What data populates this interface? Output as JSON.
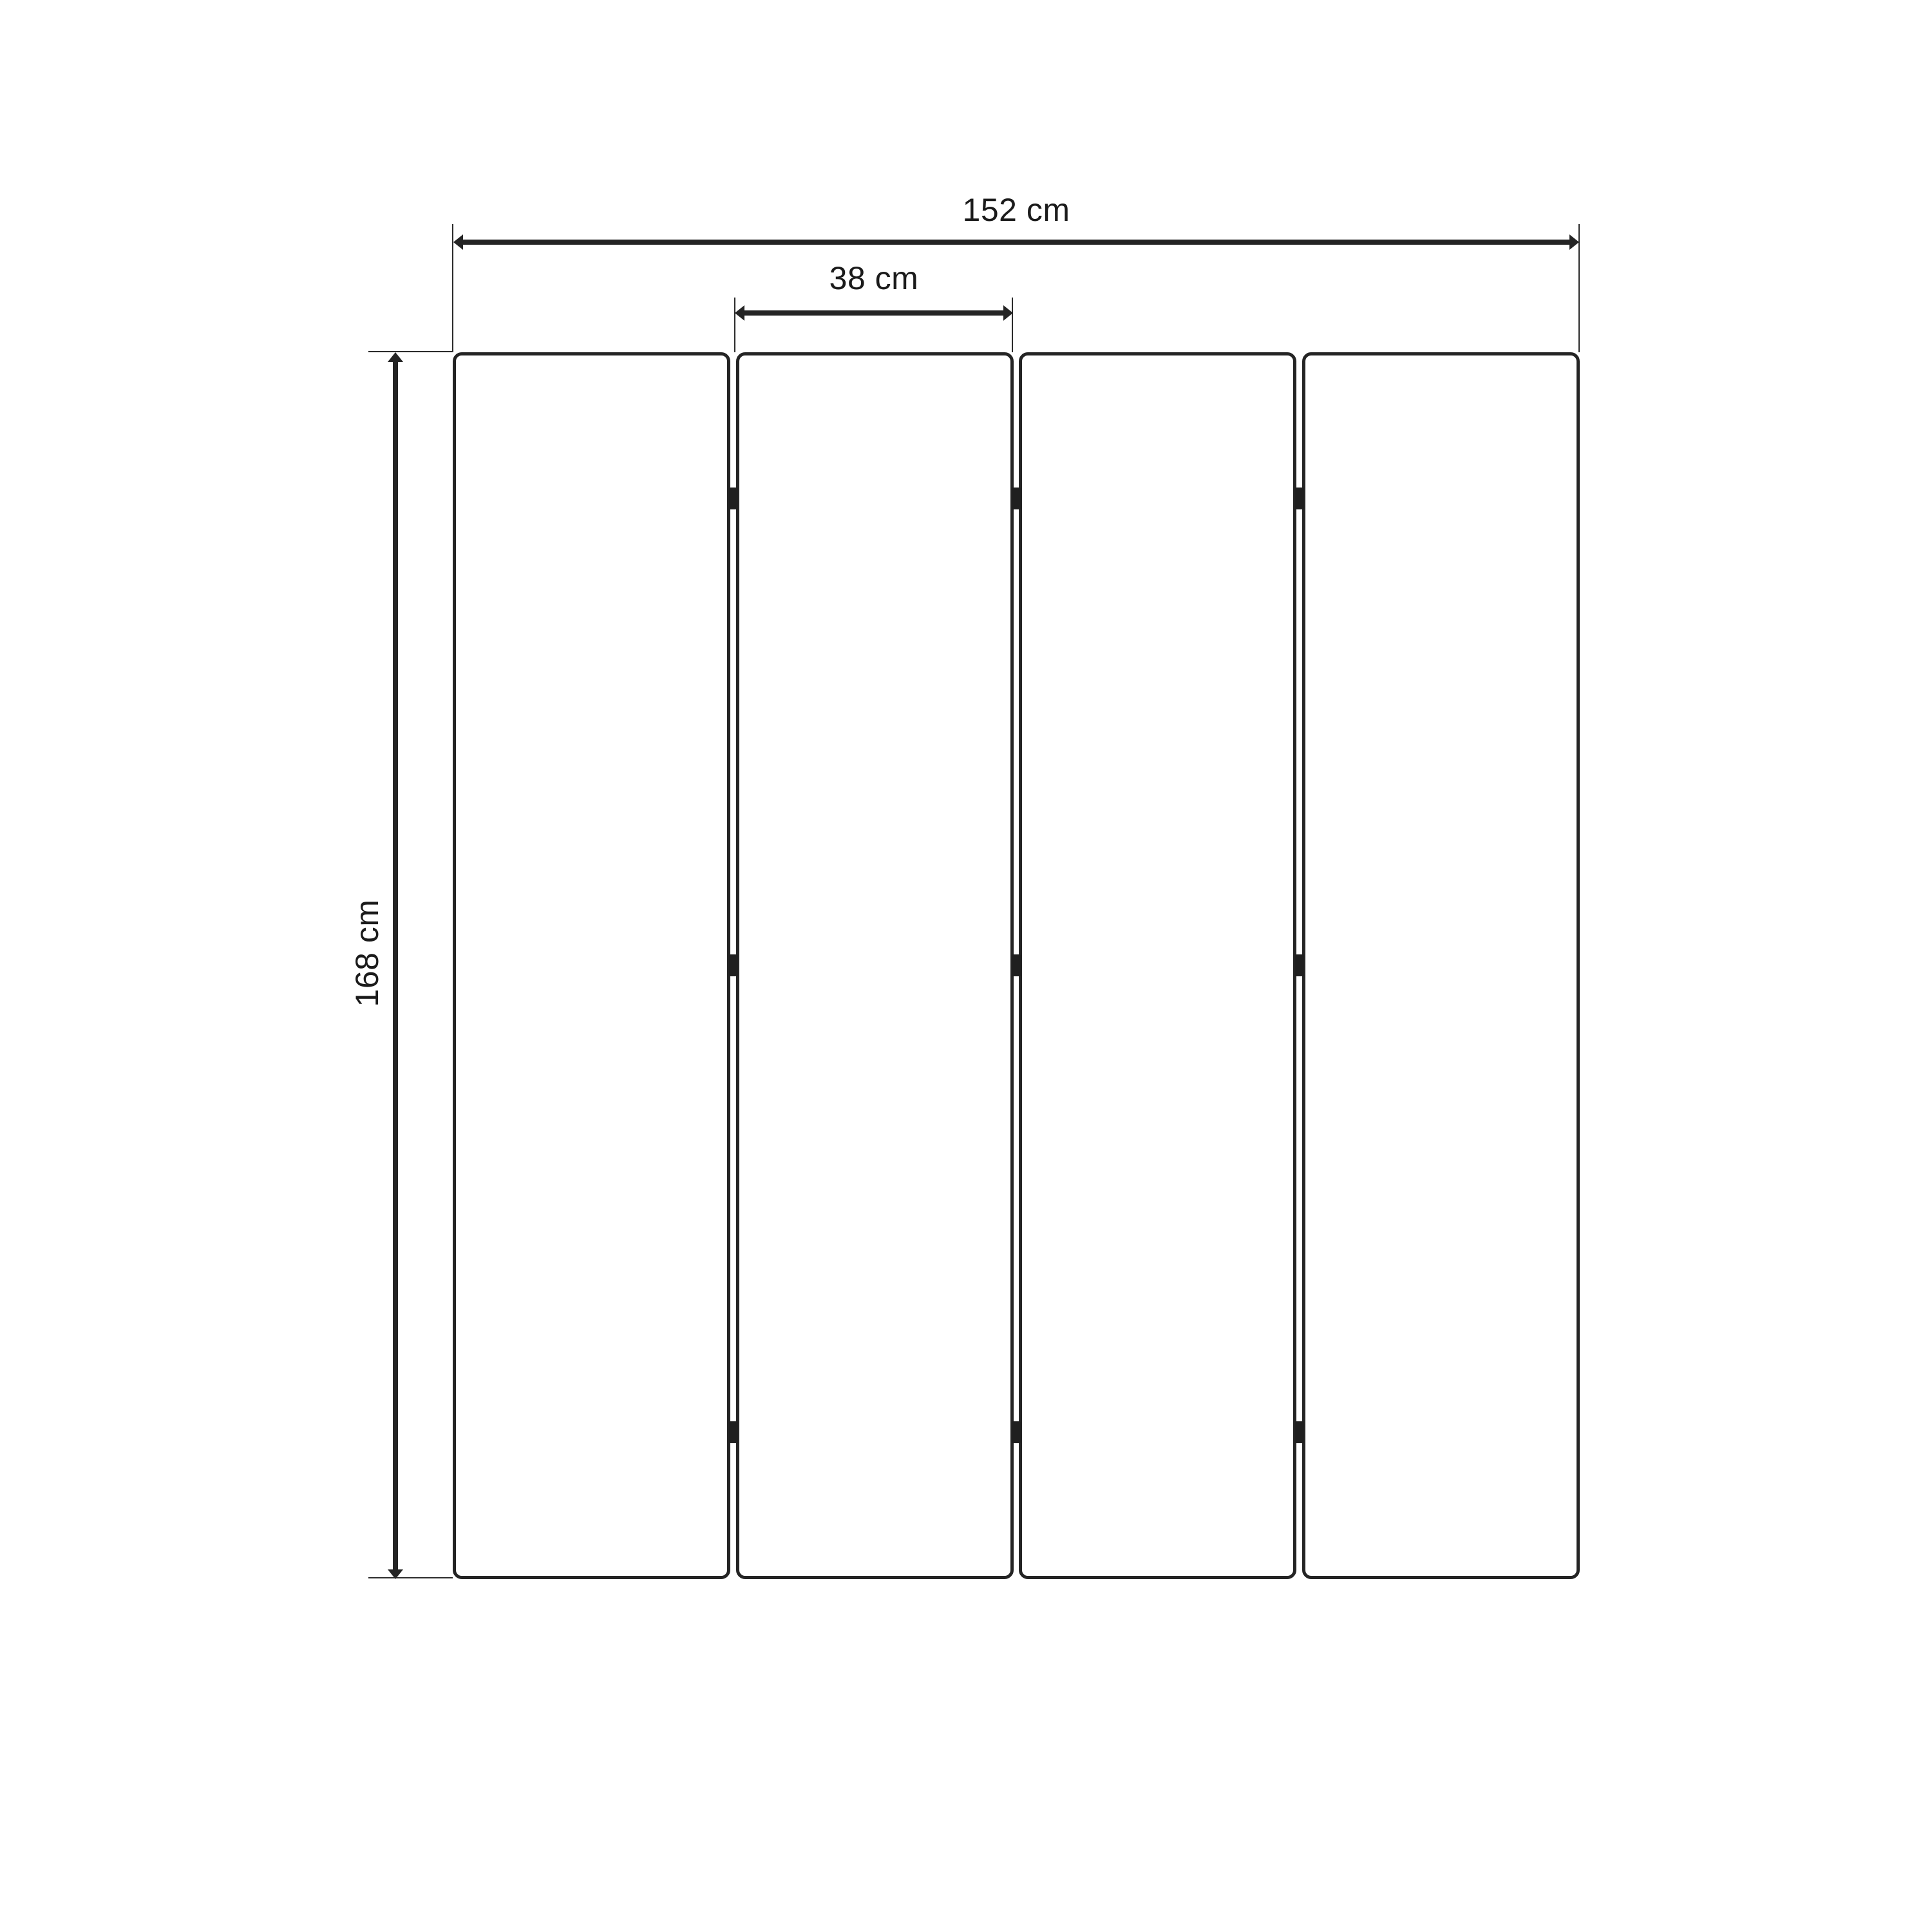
{
  "drawing": {
    "labels": {
      "total_width": "152 cm",
      "panel_width": "38 cm",
      "height": "168 cm"
    },
    "panel_count": 4,
    "hinge_rows_per_gap": 3,
    "colors": {
      "line": "#242424",
      "hinge": "#1f1f1f",
      "background": "#ffffff"
    }
  }
}
